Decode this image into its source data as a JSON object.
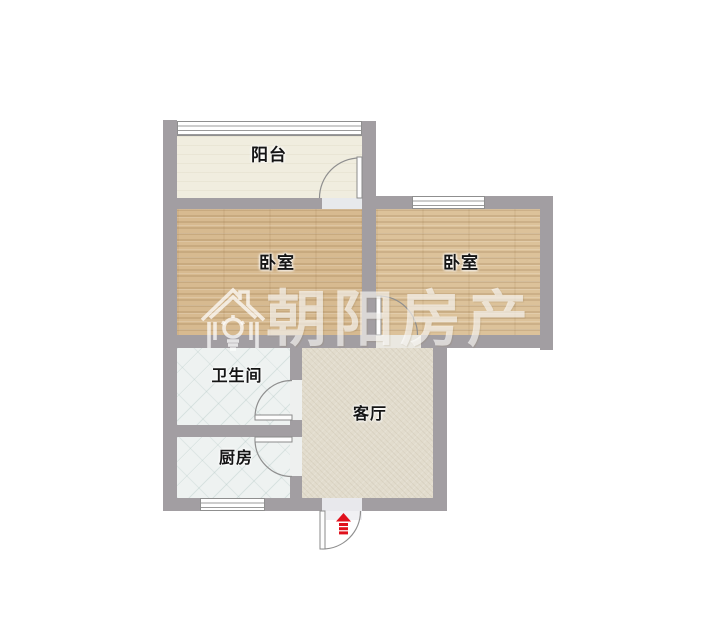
{
  "floorplan": {
    "watermark": {
      "brand_text": "朝阳房产",
      "logo": "house-sun-logo"
    },
    "rooms": [
      {
        "id": "balcony",
        "label": "阳台"
      },
      {
        "id": "bedroom-left",
        "label": "卧室"
      },
      {
        "id": "bedroom-right",
        "label": "卧室"
      },
      {
        "id": "bathroom",
        "label": "卫生间"
      },
      {
        "id": "kitchen",
        "label": "厨房"
      },
      {
        "id": "living-room",
        "label": "客厅"
      }
    ],
    "entrance": {
      "icon": "entrance-arrow-icon",
      "color": "#e0111c"
    },
    "colors": {
      "wall": "#a29ea2",
      "wood_floor": "#d7ba90",
      "tile_floor": "#eef2f1",
      "living_floor": "#e2dccd",
      "balcony_floor": "#f0eddf",
      "watermark": "rgba(255,255,255,0.62)"
    }
  }
}
